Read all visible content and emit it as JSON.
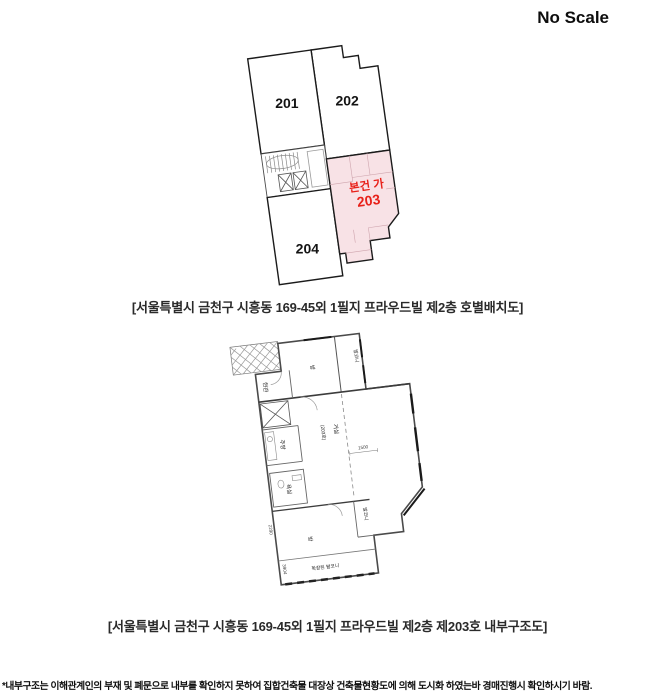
{
  "page": {
    "scale_note": "No Scale",
    "footnote": "*내부구조는 이해관계인의 부재 및 폐문으로 내부를 확인하지 못하여 집합건축물 대장상 건축물현황도에 의해 도시화 하였는바 경매진행시 확인하시기 바람."
  },
  "unit_layout": {
    "caption": "[서울특별시 금천구 시흥동 169-45외 1필지 프라우드빌 제2층 호별배치도]",
    "units": {
      "u201": "201",
      "u202": "202",
      "u204": "204"
    },
    "subject": {
      "label": "본건 가",
      "unit": "203"
    },
    "colors": {
      "highlight": "#f8e2e6",
      "subject_text": "#e8211a"
    }
  },
  "interior_layout": {
    "caption": "[서울특별시 금천구 시흥동 169-45외 1필지 프라우드빌 제2층 제203호 내부구조도]",
    "rooms": {
      "room_top": "방",
      "balcony_top": "발코니",
      "entrance": "현관",
      "kitchen": "주방",
      "bathroom": "욕실",
      "living": "거실",
      "living_no": "(203호)",
      "room_bottom": "방",
      "balcony_bottom": "발코니",
      "balcony_expanded": "확장된 발코니"
    },
    "dimensions": {
      "d1500": "1500",
      "d2290": "2290",
      "d3904": "3904"
    }
  }
}
